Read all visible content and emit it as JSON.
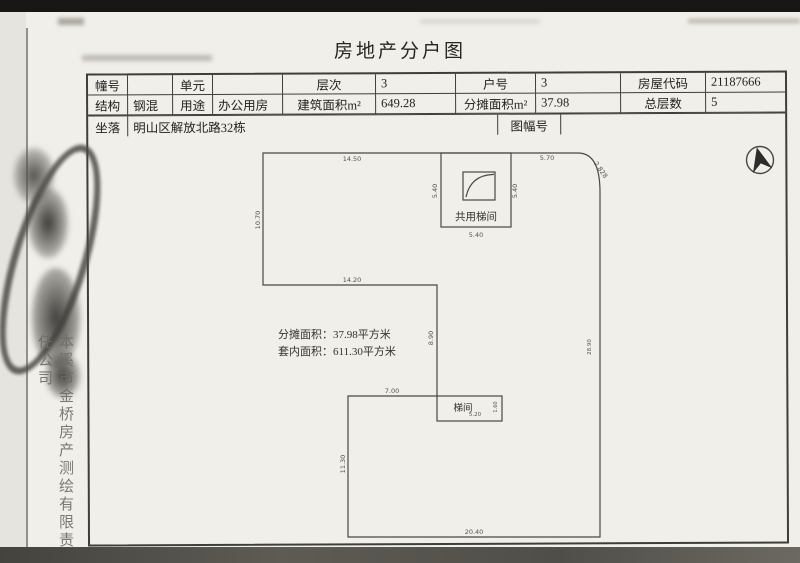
{
  "page": {
    "title": "房地产分户图"
  },
  "info_table": {
    "rows": [
      {
        "cells": [
          {
            "label": "幢号",
            "value": ""
          },
          {
            "label": "单元",
            "value": ""
          },
          {
            "label": "层次",
            "value": "3"
          },
          {
            "label": "户号",
            "value": "3"
          },
          {
            "label": "房屋代码",
            "value": "21187666"
          }
        ]
      },
      {
        "cells": [
          {
            "label": "结构",
            "value": "钢混"
          },
          {
            "label": "用途",
            "value": "办公用房"
          },
          {
            "label": "建筑面积m²",
            "value": "649.28"
          },
          {
            "label": "分摊面积m²",
            "value": "37.98"
          },
          {
            "label": "总层数",
            "value": "5"
          }
        ]
      },
      {
        "cells": [
          {
            "label": "坐落",
            "value": "明山区解放北路32栋"
          },
          {
            "label": "图幅号",
            "value": ""
          }
        ]
      }
    ]
  },
  "floor_plan": {
    "common_stairwell_label": "共用梯间",
    "stairwell_label": "梯间",
    "annotations": {
      "share_area": "分摊面积：37.98平方米",
      "inner_area": "套内面积：611.30平方米"
    },
    "dims": {
      "top_left_edge": "14.50",
      "top_right_edge": "5.70",
      "chamfer": "2.828",
      "left_edge": "10.70",
      "notch_bottom_edge": "14.20",
      "mid_vertical_edge": "8.90",
      "right_edge": "28.90",
      "stair_left": "5.40",
      "stair_right": "5.40",
      "stair_bottom": "5.40",
      "lower_top_edge": "7.00",
      "stairwell_width": "5.20",
      "stairwell_height": "1.60",
      "lower_left_edge": "11.30",
      "bottom_edge": "20.40"
    }
  },
  "side": {
    "company": "本溪市金桥房产测绘有限责任公司"
  },
  "colors": {
    "paper": "#f1efe9",
    "line": "#3f3e3b",
    "dim_text": "#55534e",
    "scan_band": "#4e4c47"
  }
}
